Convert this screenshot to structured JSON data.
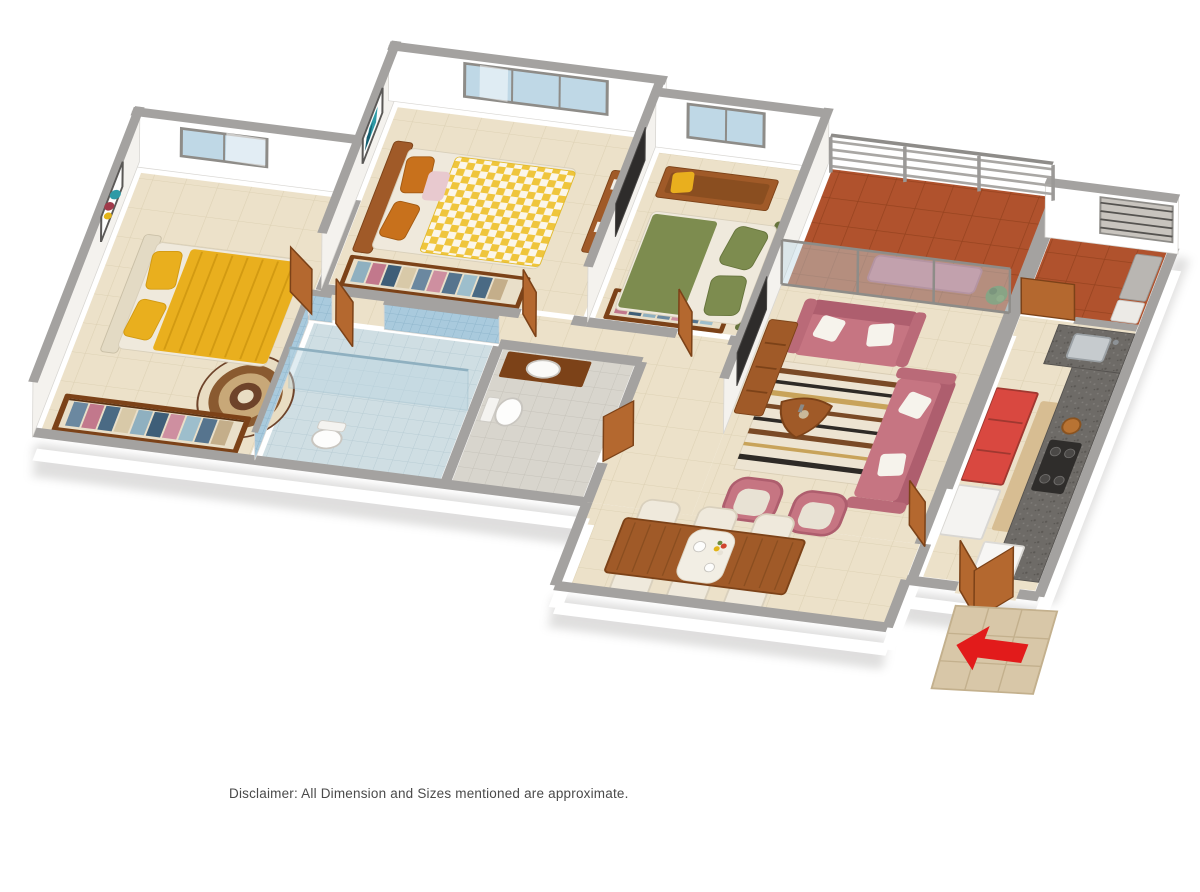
{
  "disclaimer": {
    "text": "Disclaimer: All Dimension and Sizes mentioned are approximate."
  },
  "floorplan": {
    "type": "3d-isometric-apartment-floor-plan",
    "view": "aerial cutaway, walls cut low in front, tall at back",
    "rooms": [
      {
        "name": "master-bedroom",
        "furniture": [
          "double-bed-yellow",
          "cream-headboard",
          "open-wardrobe-with-clothes",
          "round-mandala-rug",
          "wall-art",
          "window"
        ]
      },
      {
        "name": "bedroom-2",
        "furniture": [
          "double-bed-yellow-checkered",
          "orange-pillows",
          "open-wardrobe-with-clothes",
          "wall-tv-with-console",
          "wall-art",
          "window"
        ]
      },
      {
        "name": "bedroom-3",
        "furniture": [
          "double-bed-green",
          "wooden-bench",
          "open-wardrobe-with-clothes",
          "window"
        ]
      },
      {
        "name": "attached-bathroom",
        "furniture": [
          "blue-wall-tiles",
          "glass-shower-partition",
          "toilet"
        ]
      },
      {
        "name": "common-bathroom",
        "furniture": [
          "wash-basin-on-wood-counter",
          "wall-hung-toilet"
        ]
      },
      {
        "name": "living-room",
        "furniture": [
          "pink-loveseat",
          "pink-three-seat-sofa",
          "two-pink-armchairs",
          "striped-rug",
          "wood-coffee-table",
          "wall-tv-with-console"
        ]
      },
      {
        "name": "dining-area",
        "furniture": [
          "wood-dining-table",
          "six-cream-chairs",
          "table-runner-with-tea-set-and-flowers"
        ]
      },
      {
        "name": "kitchen",
        "furniture": [
          "granite-l-counter",
          "gas-hob-with-pot",
          "steel-sink",
          "red-cabinet",
          "white-appliances",
          "floor-mat"
        ]
      },
      {
        "name": "utility-balcony",
        "furniture": [
          "terracotta-floor",
          "grill-window",
          "service-unit"
        ]
      },
      {
        "name": "living-balcony",
        "furniture": [
          "terracotta-floor",
          "railing",
          "pink-bench",
          "plant",
          "sliding-glass-door"
        ]
      },
      {
        "name": "entrance",
        "furniture": [
          "open-double-wood-door",
          "beige-entry-mat",
          "red-direction-arrow"
        ]
      }
    ],
    "entrance": {
      "arrow_direction": "left-into-apartment"
    },
    "palette": {
      "wallWhite": "#ffffff",
      "wallFaceSide": "#f4f2ee",
      "wallGray": "#a4a2a0",
      "wallGrayDark": "#8f8d8b",
      "floorBeige": "#ece1c9",
      "tileLine": "#ddd1b4",
      "terracotta": "#b0522d",
      "terraLine": "#96431f",
      "bathBlue": "#a9cadd",
      "bathBlueLine": "#8fb6cc",
      "bathFloorBlue": "#cfdee3",
      "bathFloorGray": "#d8d5cd",
      "wood": "#a05a28",
      "woodDark": "#7c4218",
      "woodDoor": "#b4682f",
      "yellow": "#e9af1e",
      "yellowDeep": "#d29a12",
      "checker": "#efc53c",
      "green": "#7d8c4f",
      "greenDark": "#66743c",
      "pink": "#c67582",
      "pinkDark": "#ae5e6e",
      "cream": "#efe9dc",
      "creamDark": "#d9d0bd",
      "granite": "#6e6b67",
      "redCabinet": "#d94840",
      "arrowRed": "#e21b1b",
      "matBeige": "#d8c7a8",
      "matLine": "#c3b08d",
      "glass": "#bcd6e2",
      "glassFrame": "#8e8c88",
      "tvDark": "#2e2c2b",
      "rugCream": "#ede4d2",
      "rugBrown": "#7a4a26",
      "artTeal": "#2e9aa6"
    }
  }
}
